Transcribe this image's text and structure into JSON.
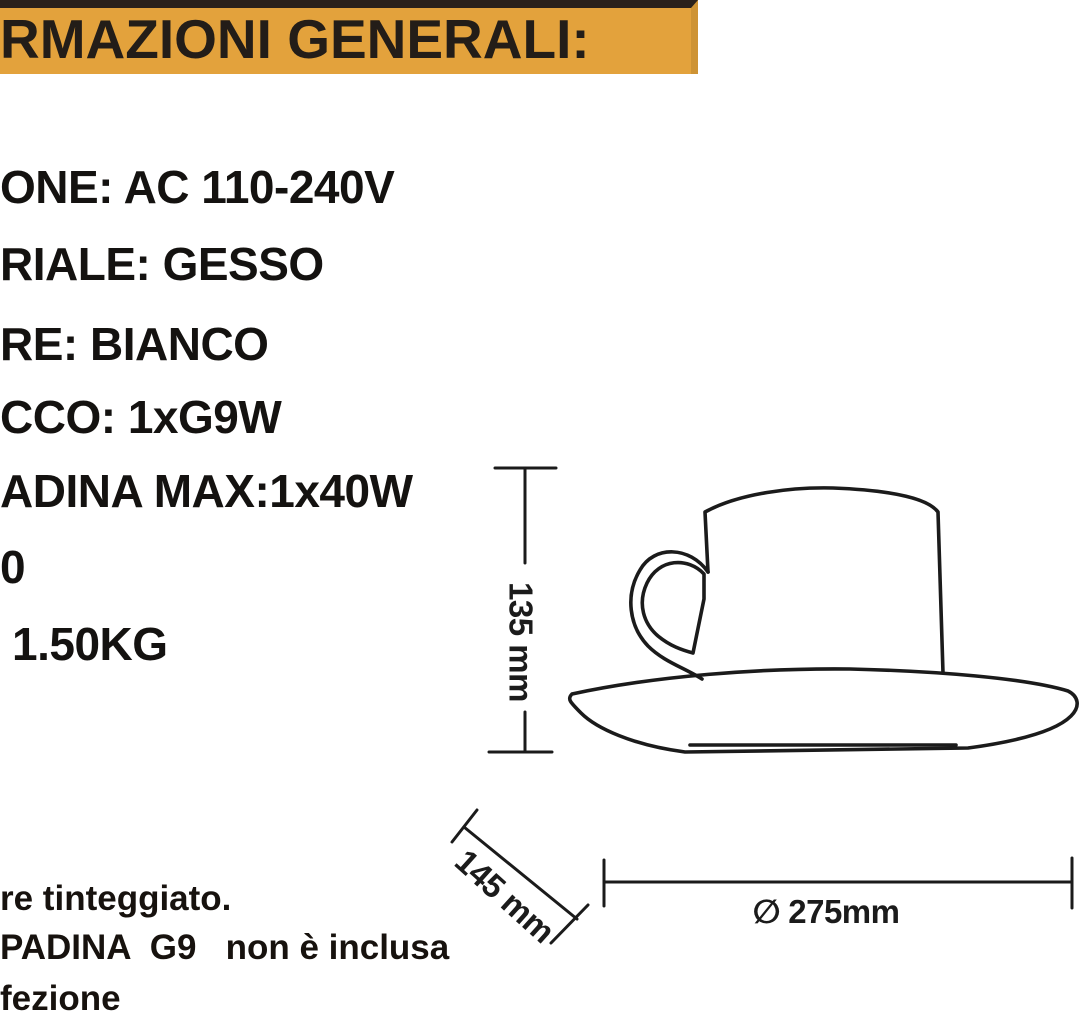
{
  "banner": {
    "title": "RMAZIONI GENERALI:",
    "bg_color": "#E3A23C",
    "top_strip_color": "#2A211B",
    "text_color": "#231D18"
  },
  "specs": [
    "ONE: AC 110-240V",
    "RIALE: GESSO",
    "RE: BIANCO",
    "CCO: 1xG9W",
    "ADINA MAX:1x40W",
    "0",
    "1.50KG"
  ],
  "notes": [
    "re tinteggiato.",
    "PADINA  G9   non è inclusa",
    "fezione"
  ],
  "diagram": {
    "height_label": "135 mm",
    "depth_label": "145 mm",
    "diameter_symbol": "∅",
    "diameter_value": "275mm",
    "line_color": "#1B1B1B"
  }
}
